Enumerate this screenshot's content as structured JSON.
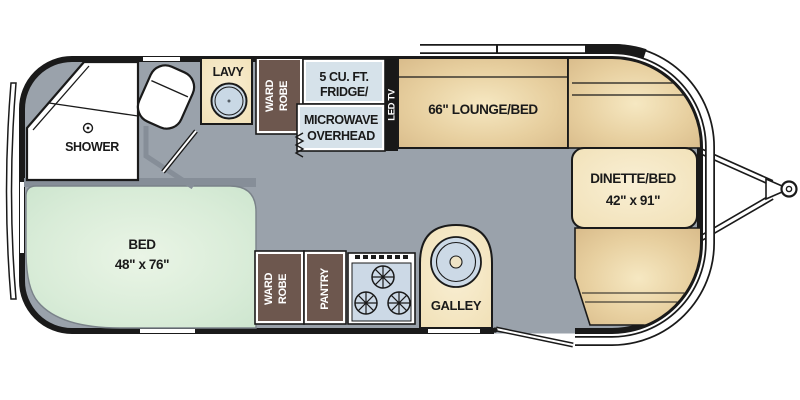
{
  "title": "Travel trailer floor plan",
  "colors": {
    "wall": "#1a1a1a",
    "floor_gray": "#9aa2ab",
    "partition_gray": "#868e98",
    "cabinet_brown": "#6d574e",
    "counter_cream": "#f6e7c4",
    "appliance_blue": "#d6e2ea",
    "sink_blue": "#c9d8e5",
    "bench_tan": "#e7cf9f",
    "bed_green": "#d9ecd8",
    "window_white": "#ffffff"
  },
  "labels": {
    "shower": "SHOWER",
    "lavy": "LAVY",
    "wardrobe_top": [
      "WARD",
      "ROBE"
    ],
    "fridge": [
      "5 CU. FT.",
      "FRIDGE/"
    ],
    "microwave": [
      "MICROWAVE",
      "OVERHEAD"
    ],
    "led_tv": "LED TV",
    "lounge": "66\" LOUNGE/BED",
    "dinette": [
      "DINETTE/BED",
      "42\" x 91\""
    ],
    "bed": [
      "BED",
      "48\" x 76\""
    ],
    "wardrobe_bottom": [
      "WARD",
      "ROBE"
    ],
    "pantry": "PANTRY",
    "galley": "GALLEY"
  }
}
